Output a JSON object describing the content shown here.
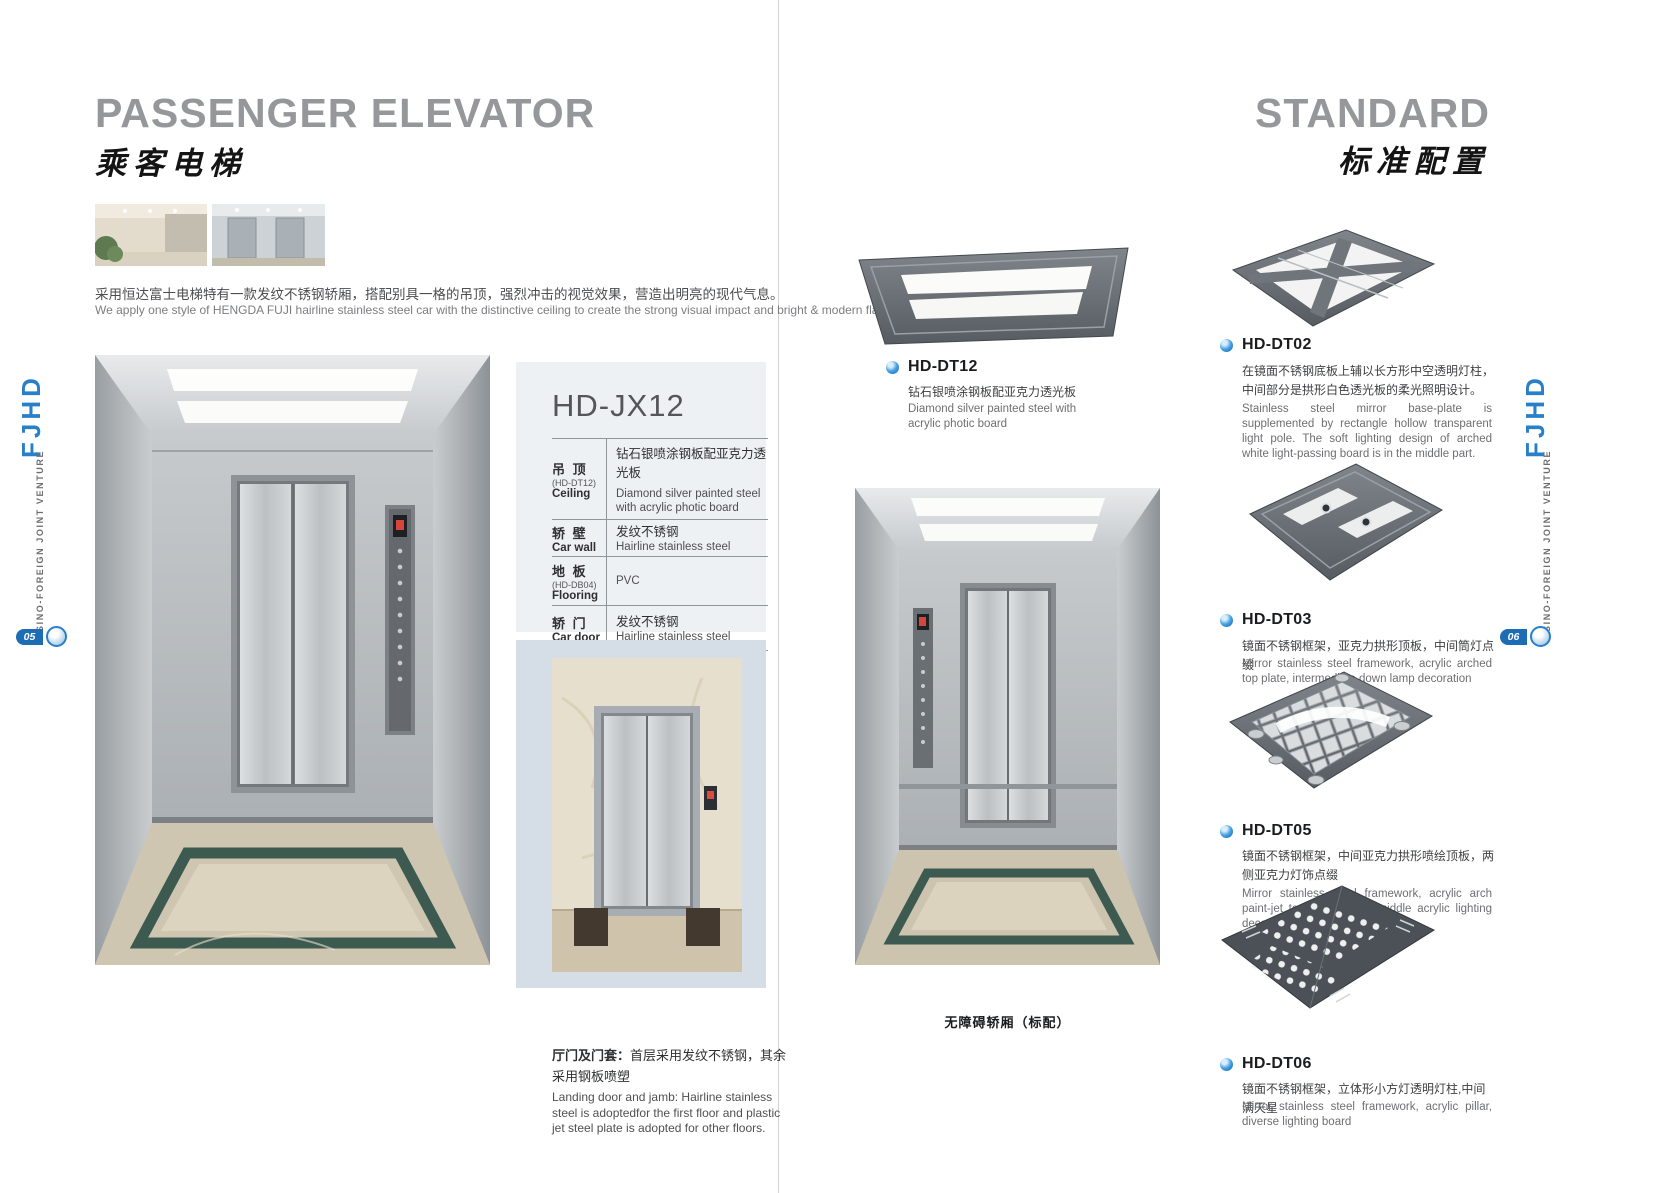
{
  "colors": {
    "accent_blue": "#2a86c9",
    "title_gray": "#96979a",
    "spec_panel": "#edf1f4",
    "door_panel": "#d5dde7"
  },
  "sidebar": {
    "brand": "FJHD",
    "tagline": "SINO-FOREIGN JOINT VENTURE"
  },
  "page_left": {
    "page_number": "05",
    "title": "PASSENGER ELEVATOR",
    "title_cn": "乘客电梯",
    "intro_cn": "采用恒达富士电梯特有一款发纹不锈钢轿厢，搭配别具一格的吊顶，强烈冲击的视觉效果，营造出明亮的现代气息。",
    "intro_en": "We apply one style of HENGDA FUJI hairline stainless steel car with the distinctive ceiling to create the strong visual impact and bright & modern flavor.",
    "model": {
      "name": "HD-JX12",
      "specs": [
        {
          "label_cn": "吊 顶",
          "label_code": "(HD-DT12)",
          "label_en": "Ceiling",
          "value_cn": "钻石银喷涂钢板配亚克力透光板",
          "value_en": "Diamond silver painted steel with acrylic photic board"
        },
        {
          "label_cn": "轿 壁",
          "label_en": "Car wall",
          "value_cn": "发纹不锈钢",
          "value_en": "Hairline stainless steel"
        },
        {
          "label_cn": "地 板",
          "label_code": "(HD-DB04)",
          "label_en": "Flooring",
          "value_en": "PVC"
        },
        {
          "label_cn": "轿 门",
          "label_en": "Car door",
          "value_cn": "发纹不锈钢",
          "value_en": "Hairline stainless steel"
        }
      ]
    },
    "landing_note": {
      "title_cn": "厅门及门套：",
      "body_cn": "首层采用发纹不锈钢，其余采用钢板喷塑",
      "body_en": "Landing door and jamb: Hairline stainless steel is adoptedfor the first floor and plastic jet steel plate is adopted for other floors."
    }
  },
  "page_right": {
    "page_number": "06",
    "title": "STANDARD",
    "title_cn": "标准配置",
    "featured": {
      "code": "HD-DT12",
      "desc_cn": "钻石银喷涂钢板配亚克力透光板",
      "desc_en": "Diamond silver painted steel with acrylic photic board"
    },
    "car_caption": "无障碍轿厢（标配）",
    "items": [
      {
        "code": "HD-DT02",
        "desc_cn": "在镜面不锈钢底板上辅以长方形中空透明灯柱，中间部分是拱形白色透光板的柔光照明设计。",
        "desc_en": "Stainless steel mirror base-plate is supplemented by rectangle hollow transparent light pole.  The soft lighting design of arched white light-passing board is in the middle part."
      },
      {
        "code": "HD-DT03",
        "desc_cn": "镜面不锈钢框架，亚克力拱形顶板，中间筒灯点缀",
        "desc_en": "Mirror stainless steel framework, acrylic arched top plate, intermediate down lamp decoration"
      },
      {
        "code": "HD-DT05",
        "desc_cn": "镜面不锈钢框架，中间亚克力拱形喷绘顶板，两侧亚克力灯饰点缀",
        "desc_en": "Mirror stainless steel framework, acrylic arch paint-jet top plate in the middle acrylic lighting decoration on both sides"
      },
      {
        "code": "HD-DT06",
        "desc_cn": "镜面不锈钢框架，立体形小方灯透明灯柱,中间满天星",
        "desc_en": "Mirror stainless steel framework, acrylic pillar, diverse lighting board"
      }
    ]
  }
}
